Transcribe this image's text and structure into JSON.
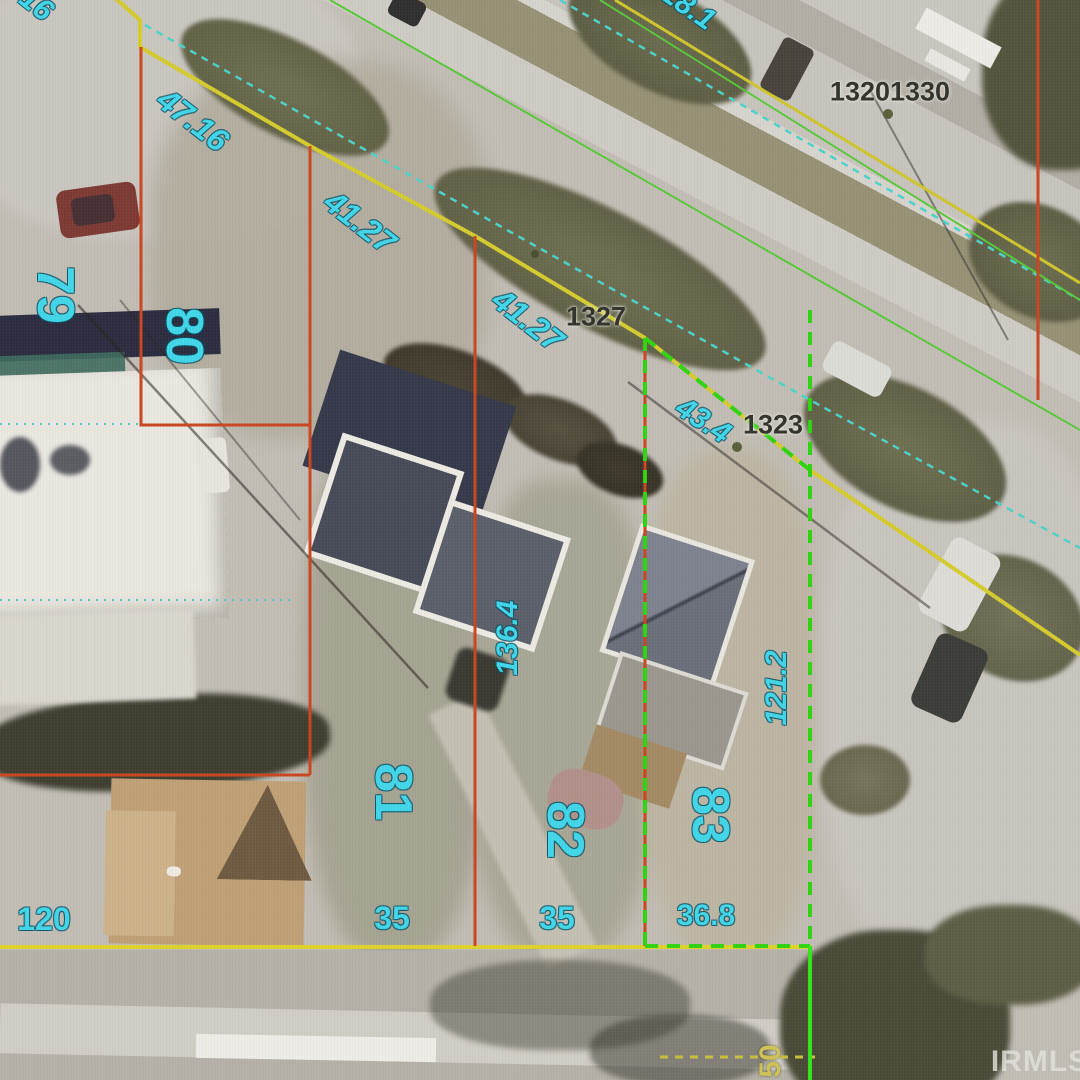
{
  "map": {
    "watermark": "IRMLS",
    "parcel_numbers": [
      "79",
      "80",
      "81",
      "82",
      "83"
    ],
    "front_dimensions": [
      "47.16",
      "41.27",
      "41.27",
      "43.4"
    ],
    "side_dimensions": [
      "136.4",
      "121.2"
    ],
    "rear_dimensions": [
      "120",
      "35",
      "35",
      "36.8"
    ],
    "edge_fragments": [
      "16",
      "18.1",
      "50"
    ],
    "address_points": [
      "13201330",
      "1327",
      "1323"
    ],
    "line_colors": {
      "parcel_boundary_red": "#cb4520",
      "highlight_boundary_green": "#2fd411",
      "lot_line_yellow": "#d5cb2e",
      "survey_line_cyan": "#4cd2c8",
      "parcel_label_cyan": "#41d6e8",
      "address_text": "#32322c"
    }
  }
}
